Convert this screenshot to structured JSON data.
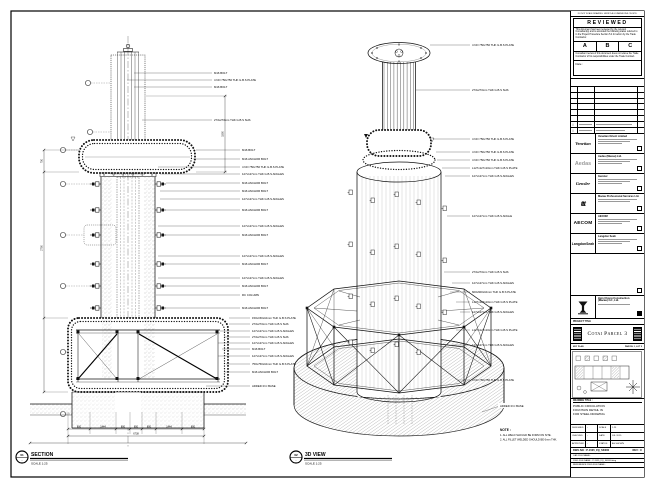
{
  "sheet": {
    "edge_note": "DO NOT SCALE DRAWING. VERIFY ALL DIMENSIONS ON SITE."
  },
  "stamp": {
    "title": "REVIEWED",
    "para1": "This document has been reviewed by the relevant Consultant(s) and is accorded the following status referred to in the Project Procedure Section 5.4 for action by the Trade Contractor.",
    "grades": [
      "A",
      "B",
      "C"
    ],
    "para2": "Consultant review of this document does not relieve the Trade Contractor of his responsibilities under the Trade Contract.",
    "date_label": "Date :"
  },
  "revisions": {
    "marker": "△"
  },
  "consultants": [
    {
      "logo": "Venetian",
      "name": "Venetian Orient Limited"
    },
    {
      "logo": "Aedas",
      "name": "Aedas (Macau) Ltd."
    },
    {
      "logo": "Gensler",
      "name": "Gensler"
    },
    {
      "logo": "ttt",
      "name": "Macau Professional Services Ltd."
    },
    {
      "logo": "AECOM",
      "name": "AECOM"
    },
    {
      "logo": "LangdonSeah",
      "name": "Langdon Seah"
    }
  ],
  "contractor": {
    "name_line1": "Hsin Chong Construction",
    "name_line2": "(Macau) Co., Ltd."
  },
  "project": {
    "label": "PROJECT TITLE",
    "name": "Cotai Parcel 3"
  },
  "key_plan": {
    "label": "KEY PLAN",
    "ref": "PARCEL 1, LOT 2"
  },
  "drawing": {
    "label": "DRAWING TITLE :",
    "line1": "PUBLIC CIRCULATION",
    "line2": "FOUNTAIN DETAIL IN",
    "line3": "FOR STEEL DRAWING"
  },
  "info": {
    "designed_label": "DESIGNED",
    "designed": "-",
    "checked_label": "CHECKED",
    "checked": "-",
    "approved_label": "APPROVED",
    "approved": "-",
    "scale_label": "SCALE",
    "scale": "1:25",
    "date_label": "DATE",
    "date": "JUL 2015",
    "status_label": "STATUS",
    "status": "AS SHOWN"
  },
  "dwg": {
    "label": "DWG NO :",
    "number": "P-1535_FQ_SK000",
    "rev_label": "REV :",
    "rev": "C"
  },
  "files": {
    "line1": "CAD FILE NAME :",
    "line2": "DWG FILE NAME : P-1535_FQ_SK000.dwg",
    "line3": "REFERENCE DWG FILE NAME :"
  },
  "views": {
    "section": {
      "bubble": "01",
      "bubble_sub": "-",
      "title": "SECTION",
      "scale": "SCALE 1:25"
    },
    "iso": {
      "bubble": "02",
      "bubble_sub": "-",
      "title": "3D VIEW",
      "scale": "SCALE 1:25"
    }
  },
  "note": {
    "title": "NOTE :",
    "l1": "1. ALL WELD SHOULD BE FORM ON SITE.",
    "l2": "2. ALL FILLET WELDED SHOULD BE 6mm THK."
  },
  "sec_callouts": [
    "M16 BOLT",
    "4 NO 750x750 THK G.B.S PLATE",
    "M16 BOLT",
    "273x273mm THK G.B.S SHS",
    "M16 BOLT",
    "M16 ANCHOR BOLT",
    "4 NO 750x750 THK G.B.S PLATE",
    "127x127mm THK G.B.S ANGLES",
    "M16 ANCHOR BOLT",
    "M16 ANCHOR BOLT",
    "127x127mm THK G.B.S ANGLES",
    "M16 ANCHOR BOLT",
    "127x127mm THK G.B.S ANGLES",
    "M16 ANCHOR BOLT",
    "127x127mm THK G.B.S ANGLES",
    "M16 ANCHOR BOLT",
    "127x127mm THK G.B.S ANGLES",
    "M16 ANCHOR BOLT",
    "RC COLUMN",
    "M16 ANCHOR BOLT",
    "150x150x10mm THK G.B.S PLATE",
    "273x273mm THK G.B.S SHS",
    "127x127mm THK G.B.S ANGLES",
    "273x273mm THK G.B.S SHS",
    "127x127mm THK G.B.S ANGLES",
    "M16 BOLT",
    "127x127mm THK G.B.S ANGLES",
    "750x750x10mm THK G.B.S PLATE",
    "M16 ANCHOR BOLT",
    "ADDED R.C BASE"
  ],
  "iso_callouts": [
    "4 NO 750x750 THK G.B.S PLATE",
    "273x273mm THK G.B.S SHS",
    "4 NO 750x750 THK G.B.S PLATE",
    "4 NO 750x750 THK G.B.S PLATE",
    "4 NO 750x750 THK G.B.S PLATE",
    "L127x127x10mm THK G.B.S PLATE",
    "127x127mm THK G.B.S ANGLES",
    "127x127mm THK G.B.S ANGLE",
    "273x273mm THK G.B.S SHS",
    "127x127mm THK G.B.S ANGLES",
    "600x600x10mm THK G.B.S PLATE",
    "L127x127x10mm THK G.B.S PLATE",
    "127x127mm THK G.B.S ANGLES",
    "L127x127x10mm THK G.B.S PLATE",
    "127x127mm THK G.B.S ANGLES",
    "4 NO 750x750 THK G.B.S PLATE",
    "ADDED R.C BASE"
  ],
  "dims": {
    "segments": [
      "800",
      "1444",
      "800",
      "650",
      "800",
      "1444",
      "800"
    ],
    "overall": "6738",
    "v1": "750",
    "v2": "2700",
    "v3": "1500"
  }
}
